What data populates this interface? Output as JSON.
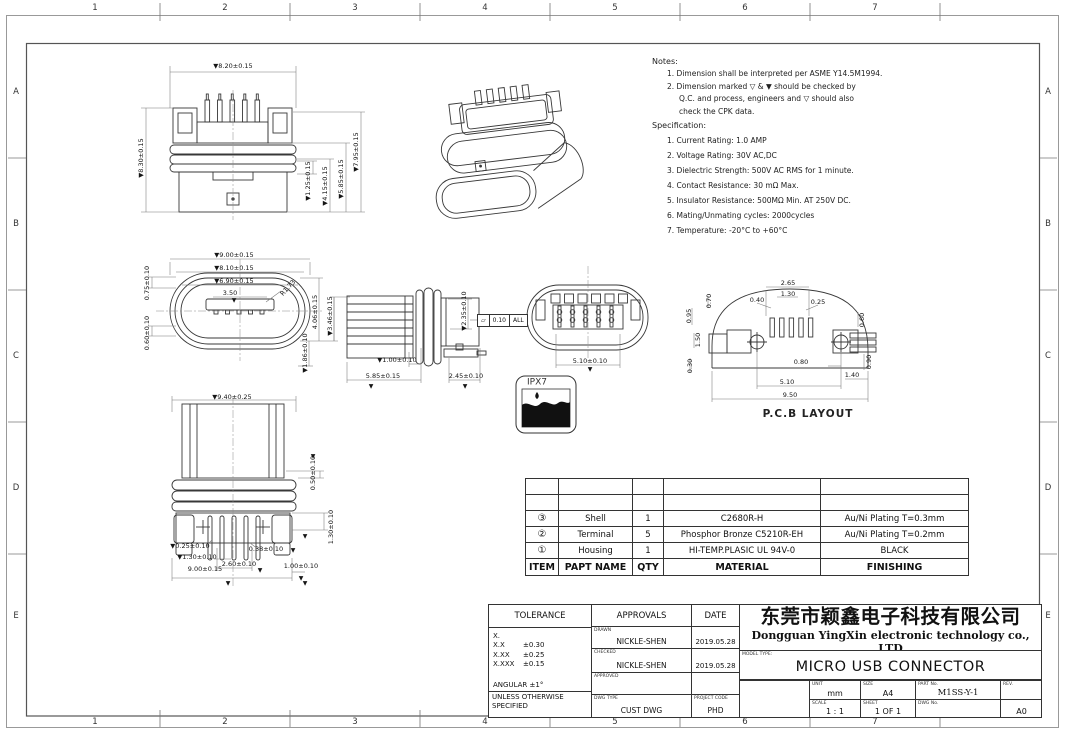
{
  "sheet": {
    "zones_top": [
      "1",
      "2",
      "3",
      "4",
      "5",
      "6",
      "7"
    ],
    "zones_side": [
      "A",
      "B",
      "C",
      "D",
      "E"
    ]
  },
  "notes": {
    "title": "Notes:",
    "line1": "1. Dimension shall be interpreted per ASME Y14.5M1994.",
    "line2": "2. Dimension marked ▽ &  ▼ should be checked by",
    "line3": "Q.C. and process, engineers and ▽ should also",
    "line4": "check the CPK data."
  },
  "spec": {
    "title": "Specification:",
    "items": [
      "1. Current Rating: 1.0 AMP",
      "2. Voltage Rating: 30V AC,DC",
      "3. Dielectric Strength: 500V AC RMS for 1 minute.",
      "4. Contact Resistance: 30 mΩ Max.",
      "5. Insulator Resistance: 500MΩ Min. AT 250V DC.",
      "6. Mating/Unmating cycles: 2000cycles",
      "7. Temperature: -20°C to +60°C"
    ]
  },
  "dims": {
    "marker": "▼",
    "front_w": "▼8.20±0.15",
    "front_h": "▼8.30±0.15",
    "front_h1": "▼1.25±0.15",
    "front_h2": "▼4.15±0.15",
    "front_h3": "▼5.85±0.15",
    "front_h4": "▼7.95±0.15",
    "oval_w1": "▼9.00±0.15",
    "oval_w2": "▼8.10±0.15",
    "oval_w3": "▼6.90±0.15",
    "oval_w4": "3.50",
    "oval_r": "R1.73",
    "oval_l1": "0.75±0.10",
    "oval_l2": "0.60±0.10",
    "oval_r1": "4.06±0.15",
    "oval_r2": "▼3.46±0.15",
    "oval_b1": "▼1.86±0.10",
    "side_r1": "▼2.35±0.10",
    "side_b1": "▼1.00±0.10",
    "side_b2": "5.85±0.15",
    "side_b3": "2.45±0.10",
    "rear_w": "5.10±0.10",
    "bottom_w": "▼9.40±0.25",
    "bottom_r1": "0.50±0.10",
    "bottom_r2": "1.30±0.10",
    "bottom_b1": "▼0.25±0.10",
    "bottom_b2": "▼1.30±0.10",
    "bottom_b3": "0.38±0.10",
    "bottom_b4": "2.60±0.10",
    "bottom_b5": "9.00±0.15",
    "bottom_b6": "1.00±0.10",
    "pcb_t1": "2.65",
    "pcb_t2": "1.30",
    "pcb_t3": "0.40",
    "pcb_t4": "0.25",
    "pcb_l1": "0.95",
    "pcb_l2": "0.70",
    "pcb_l3": "1.50",
    "pcb_l4": "0.30",
    "pcb_b1": "0.80",
    "pcb_b2": "5.10",
    "pcb_b3": "9.50",
    "pcb_r1": "0.60",
    "pcb_r2": "1.40",
    "pcb_r3": "0.90"
  },
  "callouts": {
    "pcb_label": "P.C.B LAYOUT",
    "ipx7": "IPX7",
    "flatness_symbol": "▱",
    "flatness_value": "0.10",
    "flatness_scope": "ALL"
  },
  "bom": {
    "headers": {
      "item": "ITEM",
      "part_name": "PAPT NAME",
      "qty": "QTY",
      "material": "MATERIAL",
      "finishing": "FINISHING"
    },
    "rows": [
      {
        "item": "③",
        "part_name": "Shell",
        "qty": "1",
        "material": "C2680R-H",
        "finishing": "Au/Ni  Plating T=0.3mm"
      },
      {
        "item": "②",
        "part_name": "Terminal",
        "qty": "5",
        "material": "Phosphor Bronze C5210R-EH",
        "finishing": "Au/Ni Plating T=0.2mm"
      },
      {
        "item": "①",
        "part_name": "Housing",
        "qty": "1",
        "material": "HI-TEMP.PLASIC UL 94V-0",
        "finishing": "BLACK"
      }
    ]
  },
  "title_block": {
    "tolerance": {
      "header": "TOLERANCE",
      "x_label": "X.",
      "xx_label": "X.X",
      "xx_val": "±0.30",
      "xxx_label": "X.XX",
      "xxx_val": "±0.25",
      "xxxx_label": "X.XXX",
      "xxxx_val": "±0.15",
      "angular": "ANGULAR ±1°",
      "footer1": "UNLESS OTHERWISE",
      "footer2": "SPECIFIED"
    },
    "approvals": {
      "header": "APPROVALS",
      "date_header": "DATE",
      "drawn_label": "DRAWN",
      "drawn_name": "NICKLE-SHEN",
      "drawn_date": "2019.05.28",
      "checked_label": "CHECKED",
      "checked_name": "NICKLE-SHEN",
      "checked_date": "2019.05.28",
      "approved_label": "APPROVED",
      "approved_name": "",
      "approved_date": "",
      "dwg_type_label": "DWG TYPE",
      "dwg_type": "CUST DWG",
      "project_code_label": "PROJECT CODE",
      "project_code": "PHD"
    },
    "company": {
      "cn": "东莞市颖鑫电子科技有限公司",
      "en": "Dongguan YingXin electronic technology co., LTD"
    },
    "model_type_label": "MODEL TYPE:",
    "model_type": "MICRO USB CONNECTOR",
    "fields": {
      "unit_label": "UNIT",
      "unit": "mm",
      "size_label": "SIZE",
      "size": "A4",
      "part_label": "PART No.",
      "part": "M1SS-Y-1",
      "scale_label": "SCALE",
      "scale": "1 : 1",
      "sheet_label": "SHEET",
      "sheet": "1 OF 1",
      "dwg_label": "DWG No.",
      "dwg": "",
      "rev_label": "REV.",
      "rev": "A0"
    }
  }
}
